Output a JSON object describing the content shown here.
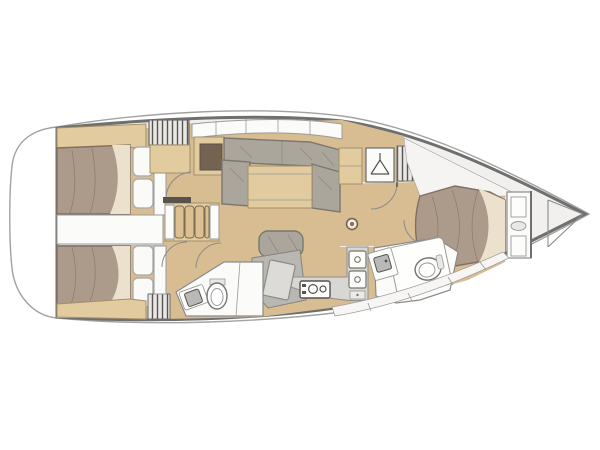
{
  "diagram": {
    "type": "sailing-yacht-interior-floorplan",
    "view": "top-down",
    "orientation": "bow-right-stern-left",
    "text_labels": [],
    "rooms": [
      {
        "id": "aft-cabin-top",
        "name": "Aft double cabin (top)",
        "items": [
          "double-berth",
          "two-pillows",
          "wood-shelf",
          "wardrobe",
          "entry-door"
        ]
      },
      {
        "id": "aft-cabin-bottom",
        "name": "Aft double cabin (bottom)",
        "items": [
          "double-berth",
          "two-pillows",
          "wood-shelf",
          "slatted-locker",
          "entry-door"
        ]
      },
      {
        "id": "engine-compartment",
        "name": "Engine / companionway space between aft cabins",
        "items": []
      },
      {
        "id": "saloon",
        "name": "Saloon",
        "items": [
          "companionway-steps",
          "u-shaped-settee",
          "saloon-table",
          "side-settee",
          "movable-bench",
          "mast-post",
          "overhead-lockers",
          "aft-cabinet"
        ]
      },
      {
        "id": "nav-station",
        "name": "Chart table / nav station",
        "items": [
          "chart-table",
          "nav-seat"
        ]
      },
      {
        "id": "galley",
        "name": "Galley",
        "items": [
          "cooktop-two-burners",
          "double-sink",
          "drawers",
          "counter"
        ]
      },
      {
        "id": "aft-head",
        "name": "Aft head (bathroom)",
        "items": [
          "toilet",
          "washbasin",
          "shower-area",
          "door"
        ]
      },
      {
        "id": "forward-cabin",
        "name": "Forward owner cabin",
        "items": [
          "island-double-berth",
          "headboard-shelves",
          "hanging-locker",
          "slatted-locker",
          "wood-lockers",
          "entry-door"
        ]
      },
      {
        "id": "forward-head",
        "name": "Forward head (en-suite)",
        "items": [
          "toilet",
          "washbasin",
          "vanity",
          "door"
        ]
      },
      {
        "id": "bow-locker",
        "name": "Bow anchor locker",
        "items": [
          "divider-bulkheads"
        ]
      },
      {
        "id": "stern-platform",
        "name": "Stern / transom platform",
        "items": []
      }
    ],
    "icons": [
      "hanger-icon",
      "burner-icon",
      "sink-drain-icon",
      "toilet-icon",
      "mast-post-icon"
    ],
    "colors": {
      "base": "#f1f0ee",
      "wood_floor": "#d9bd92",
      "wood": "#e2cb9e",
      "wood_line": "#a3906c",
      "wood_inset": "#756352",
      "bed": "#ac9a8b",
      "bed_line": "#7f7062",
      "blanket": "#ece1cc",
      "pillow": "#fafaf8",
      "cushion": "#aba69c",
      "cushion_line": "#7b776f",
      "counter": "#d8d7d3",
      "nav": "#b9b7b2",
      "fixture": "#fbfbf9",
      "hull_line": "#6f6f6d",
      "hull_outer_line": "#a2a2a0",
      "slat": "#57544e"
    }
  }
}
